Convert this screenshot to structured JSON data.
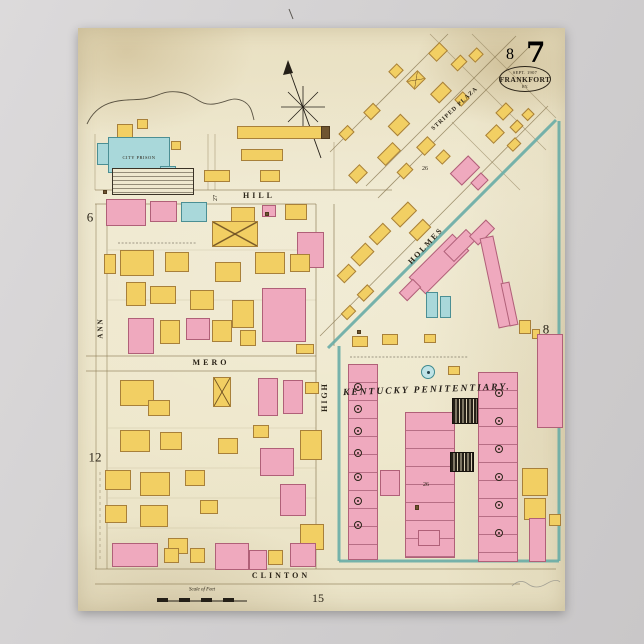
{
  "poster": {
    "title": "Sanborn fire insurance map poster, Frankfort Kentucky",
    "sheet_large": "7",
    "sheet_small": "8",
    "stamp": {
      "line1": "SEPT. 1907",
      "line2": "FRANKFORT",
      "line3": "KY."
    }
  },
  "colors": {
    "backdrop": "#d2d0d1",
    "paper": "#eee7cb",
    "ink": "#2b2418",
    "building_yellow": "#f2cf63",
    "building_pink": "#efa9be",
    "building_blue": "#a9d8da",
    "cellhouse_black": "#241f17",
    "wall_teal": "#68aca6",
    "street_line": "#8d7d57"
  },
  "labels": [
    {
      "id": "ref-sheet-left-6",
      "t": "6",
      "x": 90,
      "y": 217,
      "s": 13
    },
    {
      "id": "ref-sheet-left-12",
      "t": "12",
      "x": 95,
      "y": 457,
      "s": 13
    },
    {
      "id": "ref-sheet-right-8",
      "t": "8",
      "x": 546,
      "y": 329,
      "s": 13
    },
    {
      "id": "ref-sheet-bottom-15",
      "t": "15",
      "x": 318,
      "y": 598,
      "s": 12
    },
    {
      "id": "street-label-hill",
      "t": "HILL",
      "x": 259,
      "y": 196,
      "s": 8,
      "ls": 3,
      "cls": "street"
    },
    {
      "id": "street-label-mero",
      "t": "MERO",
      "x": 211,
      "y": 363,
      "s": 8,
      "ls": 3,
      "cls": "street"
    },
    {
      "id": "street-label-clinton",
      "t": "CLINTON",
      "x": 281,
      "y": 576,
      "s": 8,
      "ls": 3,
      "cls": "street"
    },
    {
      "id": "street-label-high",
      "t": "HIGH",
      "x": 325,
      "y": 397,
      "s": 8,
      "r": -90,
      "ls": 2,
      "cls": "street"
    },
    {
      "id": "street-label-ann",
      "t": "ANN",
      "x": 101,
      "y": 328,
      "s": 7,
      "r": -90,
      "ls": 2,
      "cls": "street"
    },
    {
      "id": "street-label-holmes",
      "t": "HOLMES",
      "x": 426,
      "y": 246,
      "s": 8,
      "r": -47,
      "ls": 2,
      "cls": "street"
    },
    {
      "id": "street-label-striped-plaza",
      "t": "STRIPED  PLAZA",
      "x": 455,
      "y": 109,
      "s": 6,
      "r": -43,
      "ls": 1,
      "cls": "street"
    },
    {
      "id": "area-label-kentucky-penitentiary",
      "t": "KENTUCKY  PENITENTIARY.",
      "x": 427,
      "y": 391,
      "s": 9.5,
      "r": -2,
      "ls": 2,
      "cls": "pen"
    },
    {
      "id": "building-label-city-prison",
      "t": "CITY PRISON",
      "x": 139,
      "y": 158,
      "s": 4.5,
      "ls": 0.5
    },
    {
      "id": "scale-label",
      "t": "Scale of Feet",
      "x": 202,
      "y": 590,
      "s": 5,
      "cls": "tiny"
    },
    {
      "id": "block-number-26-top",
      "t": "26",
      "x": 425,
      "y": 169,
      "s": 6
    },
    {
      "id": "block-number-27",
      "t": "27",
      "x": 216,
      "y": 198,
      "s": 6,
      "r": -90
    },
    {
      "id": "block-number-26-pen",
      "t": "26",
      "x": 426,
      "y": 485,
      "s": 6
    }
  ],
  "buildings": [
    [
      117,
      124,
      16,
      22,
      "y"
    ],
    [
      137,
      119,
      11,
      10,
      "y"
    ],
    [
      108,
      137,
      62,
      36,
      "b"
    ],
    [
      97,
      143,
      12,
      22,
      "b"
    ],
    [
      171,
      141,
      10,
      9,
      "y"
    ],
    [
      237,
      126,
      92,
      13,
      "y"
    ],
    [
      321,
      126,
      9,
      13,
      "o"
    ],
    [
      241,
      149,
      42,
      12,
      "y"
    ],
    [
      160,
      166,
      16,
      12,
      "b"
    ],
    [
      204,
      170,
      26,
      12,
      "y"
    ],
    [
      112,
      168,
      82,
      27,
      "t"
    ],
    [
      260,
      170,
      20,
      12,
      "y"
    ],
    [
      106,
      199,
      40,
      27,
      "p"
    ],
    [
      150,
      201,
      27,
      21,
      "p"
    ],
    [
      181,
      202,
      26,
      20,
      "b"
    ],
    [
      231,
      207,
      24,
      16,
      "y"
    ],
    [
      262,
      205,
      14,
      12,
      "p"
    ],
    [
      285,
      204,
      22,
      16,
      "y"
    ],
    [
      297,
      232,
      27,
      36,
      "p"
    ],
    [
      212,
      221,
      46,
      26,
      "y",
      0,
      "x"
    ],
    [
      120,
      250,
      34,
      26,
      "y"
    ],
    [
      104,
      254,
      12,
      20,
      "y"
    ],
    [
      165,
      252,
      24,
      20,
      "y"
    ],
    [
      215,
      262,
      26,
      20,
      "y"
    ],
    [
      255,
      252,
      30,
      22,
      "y"
    ],
    [
      290,
      254,
      20,
      18,
      "y"
    ],
    [
      126,
      282,
      20,
      24,
      "y"
    ],
    [
      150,
      286,
      26,
      18,
      "y"
    ],
    [
      190,
      290,
      24,
      20,
      "y"
    ],
    [
      232,
      300,
      22,
      28,
      "y"
    ],
    [
      262,
      288,
      44,
      54,
      "p"
    ],
    [
      128,
      318,
      26,
      36,
      "p"
    ],
    [
      160,
      320,
      20,
      24,
      "y"
    ],
    [
      186,
      318,
      24,
      22,
      "p"
    ],
    [
      212,
      320,
      20,
      22,
      "y"
    ],
    [
      240,
      330,
      16,
      16,
      "y"
    ],
    [
      296,
      344,
      18,
      10,
      "y"
    ],
    [
      265,
      212,
      4,
      4,
      "o"
    ],
    [
      103,
      190,
      4,
      4,
      "o"
    ],
    [
      120,
      380,
      34,
      26,
      "y"
    ],
    [
      148,
      400,
      22,
      16,
      "y"
    ],
    [
      213,
      377,
      18,
      30,
      "y",
      0,
      "x"
    ],
    [
      258,
      378,
      20,
      38,
      "p"
    ],
    [
      283,
      380,
      20,
      34,
      "p"
    ],
    [
      305,
      382,
      14,
      12,
      "y"
    ],
    [
      253,
      425,
      16,
      13,
      "y"
    ],
    [
      120,
      430,
      30,
      22,
      "y"
    ],
    [
      160,
      432,
      22,
      18,
      "y"
    ],
    [
      218,
      438,
      20,
      16,
      "y"
    ],
    [
      260,
      448,
      34,
      28,
      "p"
    ],
    [
      105,
      470,
      26,
      20,
      "y"
    ],
    [
      140,
      472,
      30,
      24,
      "y"
    ],
    [
      185,
      470,
      20,
      16,
      "y"
    ],
    [
      300,
      430,
      22,
      30,
      "y"
    ],
    [
      105,
      505,
      22,
      18,
      "y"
    ],
    [
      140,
      505,
      28,
      22,
      "y"
    ],
    [
      200,
      500,
      18,
      14,
      "y"
    ],
    [
      280,
      484,
      26,
      32,
      "p"
    ],
    [
      300,
      524,
      24,
      26,
      "y"
    ],
    [
      168,
      538,
      20,
      16,
      "y"
    ],
    [
      112,
      543,
      46,
      24,
      "p"
    ],
    [
      164,
      548,
      15,
      15,
      "y"
    ],
    [
      190,
      548,
      15,
      15,
      "y"
    ],
    [
      215,
      543,
      34,
      27,
      "p"
    ],
    [
      249,
      550,
      18,
      20,
      "p"
    ],
    [
      268,
      550,
      15,
      15,
      "y"
    ],
    [
      290,
      543,
      26,
      24,
      "p"
    ],
    [
      430,
      46,
      16,
      12,
      "y",
      -45
    ],
    [
      452,
      58,
      14,
      10,
      "y",
      -45
    ],
    [
      470,
      50,
      12,
      10,
      "y",
      -45
    ],
    [
      497,
      106,
      15,
      11,
      "y",
      -45
    ],
    [
      511,
      122,
      11,
      9,
      "y",
      -45
    ],
    [
      523,
      110,
      10,
      9,
      "y",
      -45
    ],
    [
      408,
      74,
      16,
      12,
      "y",
      -45,
      "x"
    ],
    [
      390,
      66,
      12,
      10,
      "y",
      -45
    ],
    [
      432,
      86,
      18,
      13,
      "y",
      -45
    ],
    [
      456,
      94,
      12,
      10,
      "y",
      -45
    ],
    [
      365,
      106,
      14,
      11,
      "y",
      -45
    ],
    [
      390,
      118,
      18,
      14,
      "y",
      -45
    ],
    [
      340,
      128,
      13,
      10,
      "y",
      -45
    ],
    [
      418,
      140,
      16,
      12,
      "y",
      -45
    ],
    [
      437,
      152,
      12,
      10,
      "y",
      -45
    ],
    [
      378,
      148,
      22,
      12,
      "y",
      -45
    ],
    [
      350,
      168,
      16,
      12,
      "y",
      -45
    ],
    [
      398,
      166,
      14,
      10,
      "y",
      -45
    ],
    [
      452,
      162,
      26,
      17,
      "p",
      -45
    ],
    [
      472,
      176,
      15,
      11,
      "p",
      -45
    ],
    [
      487,
      128,
      16,
      12,
      "y",
      -45
    ],
    [
      508,
      140,
      12,
      9,
      "y",
      -45
    ],
    [
      392,
      208,
      24,
      13,
      "y",
      -45
    ],
    [
      410,
      224,
      20,
      12,
      "y",
      -45
    ],
    [
      370,
      228,
      20,
      12,
      "y",
      -45
    ],
    [
      352,
      248,
      21,
      13,
      "y",
      -45
    ],
    [
      338,
      268,
      17,
      11,
      "y",
      -45
    ],
    [
      358,
      288,
      15,
      10,
      "y",
      -45
    ],
    [
      342,
      308,
      13,
      9,
      "y",
      -45
    ],
    [
      408,
      252,
      62,
      24,
      "p",
      -45
    ],
    [
      444,
      238,
      32,
      15,
      "p",
      -45
    ],
    [
      470,
      226,
      24,
      13,
      "p",
      -45
    ],
    [
      400,
      284,
      20,
      12,
      "p",
      -45
    ],
    [
      426,
      292,
      12,
      26,
      "b"
    ],
    [
      440,
      296,
      11,
      22,
      "b"
    ],
    [
      489,
      236,
      14,
      92,
      "p",
      -12
    ],
    [
      505,
      282,
      9,
      44,
      "p",
      -12
    ],
    [
      519,
      320,
      12,
      14,
      "y"
    ],
    [
      532,
      329,
      8,
      10,
      "y"
    ],
    [
      537,
      334,
      26,
      94,
      "p"
    ],
    [
      348,
      364,
      30,
      196,
      "p",
      0,
      "lh"
    ],
    [
      380,
      470,
      20,
      26,
      "p"
    ],
    [
      405,
      412,
      50,
      146,
      "p",
      0,
      "lh"
    ],
    [
      452,
      398,
      26,
      26,
      "k"
    ],
    [
      450,
      452,
      24,
      20,
      "k"
    ],
    [
      478,
      372,
      40,
      190,
      "p",
      0,
      "lh"
    ],
    [
      352,
      336,
      16,
      11,
      "y"
    ],
    [
      382,
      334,
      16,
      11,
      "y"
    ],
    [
      424,
      334,
      12,
      9,
      "y"
    ],
    [
      448,
      366,
      12,
      9,
      "y"
    ],
    [
      418,
      530,
      22,
      16,
      "p"
    ],
    [
      357,
      330,
      4,
      4,
      "o"
    ],
    [
      415,
      505,
      4,
      5,
      "o"
    ],
    [
      522,
      468,
      26,
      28,
      "y"
    ],
    [
      524,
      498,
      22,
      22,
      "y"
    ],
    [
      529,
      518,
      17,
      44,
      "p"
    ],
    [
      549,
      514,
      12,
      12,
      "y"
    ]
  ],
  "symbols": {
    "machine_circles": [
      [
        357,
        386
      ],
      [
        357,
        408
      ],
      [
        357,
        430
      ],
      [
        357,
        452
      ],
      [
        357,
        476
      ],
      [
        357,
        500
      ],
      [
        357,
        524
      ],
      [
        498,
        392
      ],
      [
        498,
        420
      ],
      [
        498,
        448
      ],
      [
        498,
        476
      ],
      [
        498,
        504
      ],
      [
        498,
        532
      ]
    ],
    "water_tank": {
      "x": 427,
      "y": 371,
      "r": 6
    }
  },
  "paths": [
    {
      "id": "street-hill-north",
      "d": "M95 190 H392",
      "s": "#8d7d57",
      "w": 0.8,
      "o": 0.85
    },
    {
      "id": "street-hill-south",
      "d": "M95 204 H316",
      "s": "#8d7d57",
      "w": 0.8,
      "o": 0.85
    },
    {
      "id": "street-mero-north",
      "d": "M86 356 H316",
      "s": "#8d7d57",
      "w": 0.8,
      "o": 0.85
    },
    {
      "id": "street-mero-south",
      "d": "M86 371 H316",
      "s": "#8d7d57",
      "w": 0.8,
      "o": 0.85
    },
    {
      "id": "street-clinton-north",
      "d": "M95 569 H556",
      "s": "#8d7d57",
      "w": 0.8,
      "o": 0.85
    },
    {
      "id": "street-clinton-south",
      "d": "M95 584 H520",
      "s": "#8d7d57",
      "w": 0.8,
      "o": 0.85
    },
    {
      "id": "street-high-west",
      "d": "M316 204 V569",
      "s": "#8d7d57",
      "w": 0.8,
      "o": 0.85
    },
    {
      "id": "street-high-east",
      "d": "M334 204 V346",
      "s": "#8d7d57",
      "w": 0.8,
      "o": 0.85
    },
    {
      "id": "street-ann-west",
      "d": "M96 204 V569",
      "s": "#8d7d57",
      "w": 0.8,
      "o": 0.7
    },
    {
      "id": "street-ann-east",
      "d": "M107 204 V569",
      "s": "#8d7d57",
      "w": 0.8,
      "o": 0.7
    },
    {
      "id": "alley-27-west",
      "d": "M208 134 V190",
      "s": "#8d7d57",
      "w": 0.7,
      "o": 0.6
    },
    {
      "id": "alley-27-east",
      "d": "M215 134 V190",
      "s": "#8d7d57",
      "w": 0.7,
      "o": 0.6
    },
    {
      "id": "block-topleft-west",
      "d": "M95 134 V190",
      "s": "#8d7d57",
      "w": 0.7,
      "o": 0.6
    },
    {
      "id": "block-topleft-east",
      "d": "M334 142 V190",
      "s": "#8d7d57",
      "w": 0.7,
      "o": 0.6
    },
    {
      "id": "lot-line-1",
      "d": "M108 250 H316",
      "s": "#8d7d57",
      "w": 0.6,
      "o": 0.3
    },
    {
      "id": "lot-line-2",
      "d": "M108 300 H316",
      "s": "#8d7d57",
      "w": 0.6,
      "o": 0.3
    },
    {
      "id": "lot-line-3",
      "d": "M108 428 H316",
      "s": "#8d7d57",
      "w": 0.6,
      "o": 0.3
    },
    {
      "id": "lot-line-4",
      "d": "M108 468 H316",
      "s": "#8d7d57",
      "w": 0.6,
      "o": 0.3
    },
    {
      "id": "lot-line-5",
      "d": "M108 498 H316",
      "s": "#8d7d57",
      "w": 0.6,
      "o": 0.3
    },
    {
      "id": "lot-line-6",
      "d": "M108 528 H316",
      "s": "#8d7d57",
      "w": 0.6,
      "o": 0.3
    },
    {
      "id": "diag-street-1",
      "d": "M330 152 L448 34",
      "s": "#8d7d57",
      "w": 0.8,
      "o": 0.8
    },
    {
      "id": "diag-plaza-nw",
      "d": "M366 186 L516 36",
      "s": "#8d7d57",
      "w": 0.8,
      "o": 0.8
    },
    {
      "id": "diag-plaza-se",
      "d": "M378 198 L530 46",
      "s": "#8d7d57",
      "w": 0.8,
      "o": 0.8
    },
    {
      "id": "diag-holmes-nw",
      "d": "M320 336 L548 106",
      "s": "#8d7d57",
      "w": 0.8,
      "o": 0.8
    },
    {
      "id": "diag-cross-1",
      "d": "M430 34 L546 150",
      "s": "#8d7d57",
      "w": 0.7,
      "o": 0.6
    },
    {
      "id": "diag-cross-2",
      "d": "M472 34 L556 118",
      "s": "#8d7d57",
      "w": 0.7,
      "o": 0.6
    },
    {
      "id": "diag-cross-3",
      "d": "M452 122 L520 190",
      "s": "#8d7d57",
      "w": 0.7,
      "o": 0.6
    },
    {
      "id": "dashed-lot-line",
      "d": "M100 472 V562",
      "s": "#6b5c3e",
      "w": 0.7,
      "o": 0.5,
      "da": "3 3"
    },
    {
      "id": "wall-holmes-teal",
      "d": "M328 348 L556 120",
      "s": "#68aca6",
      "w": 3,
      "o": 0.9
    },
    {
      "id": "pen-wall-west",
      "d": "M339 346 V561",
      "s": "#68aca6",
      "w": 3,
      "o": 0.9
    },
    {
      "id": "pen-wall-south",
      "d": "M339 561 H559",
      "s": "#68aca6",
      "w": 3,
      "o": 0.9
    },
    {
      "id": "pen-wall-east",
      "d": "M559 561 V121",
      "s": "#68aca6",
      "w": 3,
      "o": 0.9
    },
    {
      "id": "boundary-curve",
      "d": "M87 124 C100 96 128 101 143 99 C158 97 163 90 178 92 C196 94 198 106 214 104 C228 102 232 96 243 101 C251 105 252 112 254 120",
      "s": "#2b2418",
      "w": 0.9,
      "o": 0.75
    },
    {
      "id": "compass-axis",
      "d": "M288 66 L321 158",
      "s": "#241f17",
      "w": 0.9
    },
    {
      "id": "compass-star-1",
      "d": "M281 107 L325 107",
      "s": "#241f17",
      "w": 0.8
    },
    {
      "id": "compass-star-2",
      "d": "M303 86 L303 128",
      "s": "#241f17",
      "w": 0.8
    },
    {
      "id": "compass-star-3",
      "d": "M288 92 L318 122",
      "s": "#241f17",
      "w": 0.8
    },
    {
      "id": "compass-star-4",
      "d": "M288 122 L318 92",
      "s": "#241f17",
      "w": 0.8
    },
    {
      "id": "compass-arrowhead",
      "d": "M288 60 L283 75 L293 73 Z",
      "s": "none",
      "f": "#241f17"
    },
    {
      "id": "top-edge-tick",
      "d": "M289 9 L293 19",
      "s": "#241f17",
      "w": 1,
      "o": 0.7
    },
    {
      "id": "pen-note-line",
      "d": "M350 357 H468",
      "s": "#3a3226",
      "w": 1,
      "o": 0.45,
      "da": "2 1.6"
    },
    {
      "id": "legend-note-line",
      "d": "M118 243 H196",
      "s": "#3a3226",
      "w": 1,
      "o": 0.45,
      "da": "2 1.6"
    },
    {
      "id": "scale-bar-baseline",
      "d": "M157 601 H247",
      "s": "#241f17",
      "w": 1
    },
    {
      "id": "scale-bar-seg-1",
      "d": "M157 598 h11 v4 h-11 Z",
      "s": "none",
      "f": "#241f17"
    },
    {
      "id": "scale-bar-seg-2",
      "d": "M179 598 h11 v4 h-11 Z",
      "s": "none",
      "f": "#241f17"
    },
    {
      "id": "scale-bar-seg-3",
      "d": "M201 598 h11 v4 h-11 Z",
      "s": "none",
      "f": "#241f17"
    },
    {
      "id": "scale-bar-seg-4",
      "d": "M223 598 h11 v4 h-11 Z",
      "s": "none",
      "f": "#241f17"
    },
    {
      "id": "pencil-squiggle",
      "d": "M512 586 q8 -8 16 -2 t18 0 t14 -2",
      "s": "#8a8a84",
      "w": 0.8,
      "o": 0.7
    }
  ]
}
